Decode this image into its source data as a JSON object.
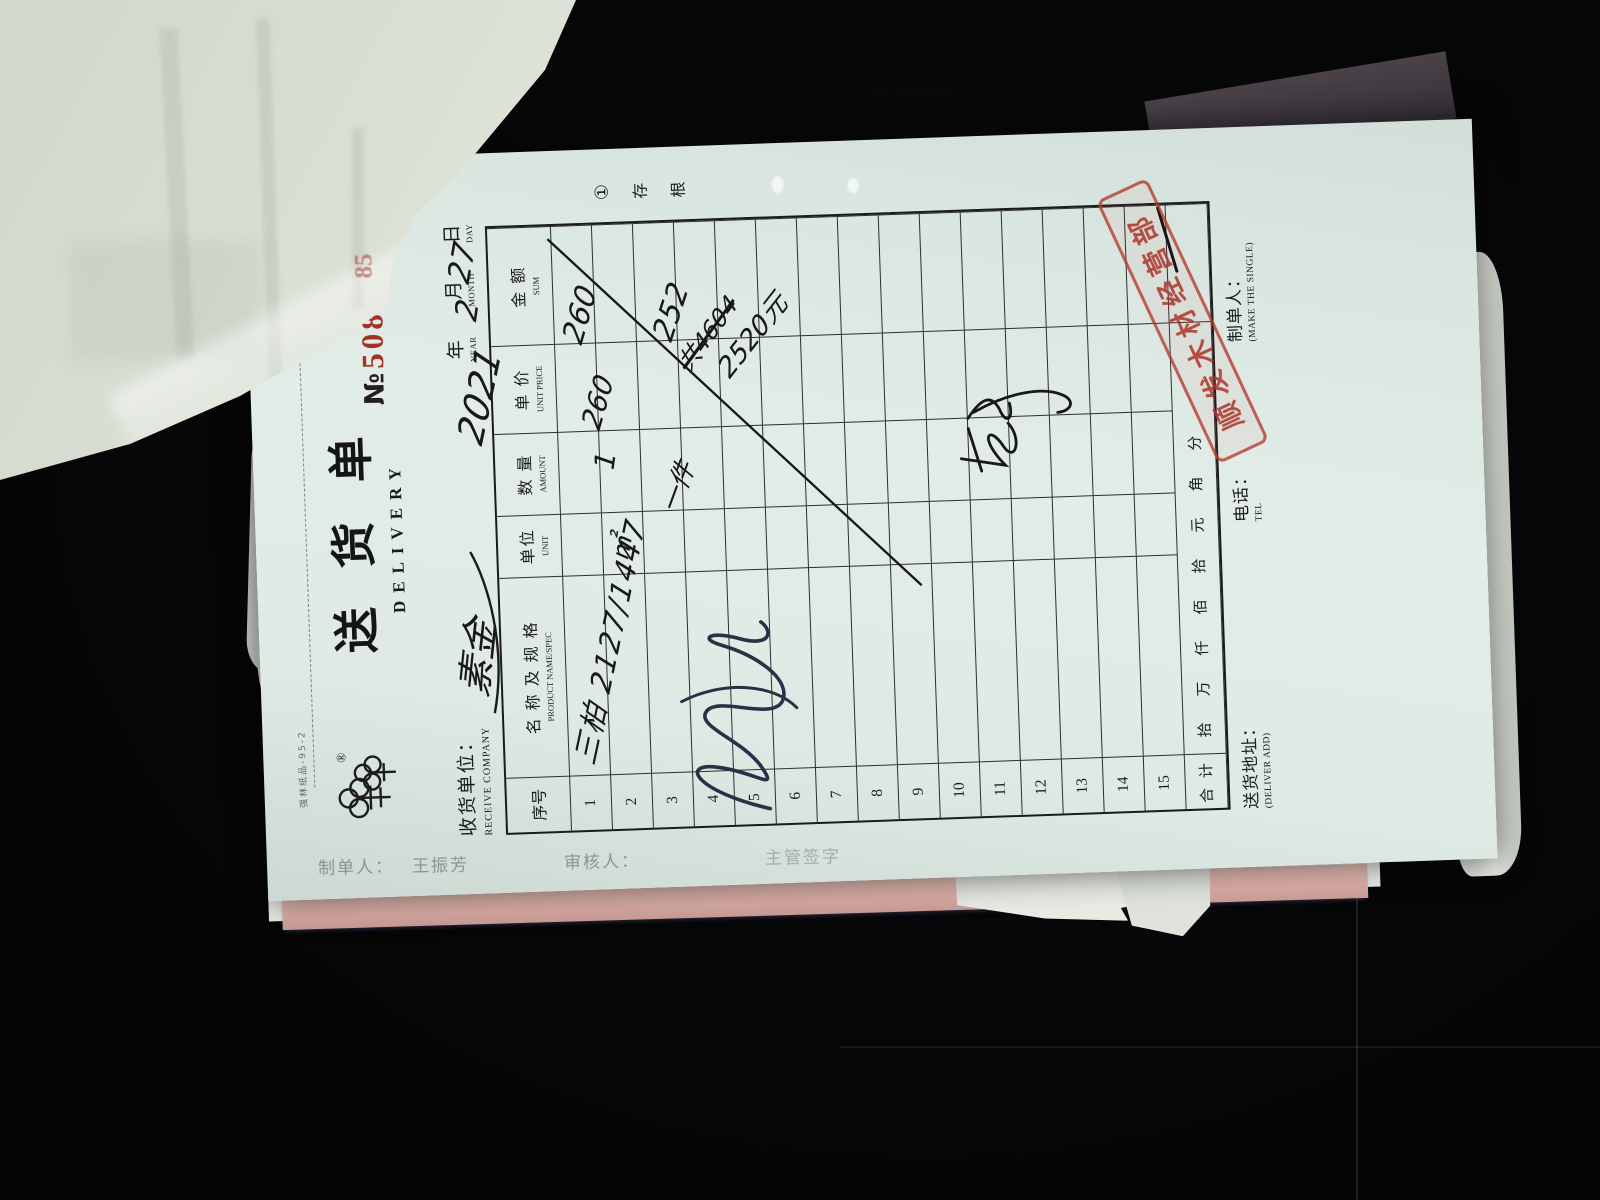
{
  "colors": {
    "background": "#060608",
    "paper": "#dfeae4",
    "pink_sheet": "#e0b4ab",
    "number_red": "#a33226",
    "stamp_red": "#b5463a",
    "ink_black": "#17171c",
    "ink_blue": "#2a3147"
  },
  "form": {
    "edge_print": "强林纸品-95-2",
    "logo": {
      "icon": "double-tree-logo",
      "registered_mark": "®"
    },
    "title_cn": "送 货 单",
    "title_en": "DELIVERY",
    "no_symbol": "№",
    "no_digits": "50850",
    "receive_company_cn": "收货单位：",
    "receive_company_en": "RECEIVE COMPANY",
    "date_line": {
      "year_cn": "年",
      "year_en": "YEAR",
      "month_cn": "月",
      "month_en": "MONTH",
      "day_cn": "日",
      "day_en": "DAY"
    },
    "stub_mark": {
      "circled_one": "①",
      "char1": "存",
      "char2": "根"
    },
    "table": {
      "col_seq_cn": "序号",
      "col_name_cn": "名 称 及 规 格",
      "col_name_en": "PRODUCT NAME/SPEC",
      "col_unit_cn": "单位",
      "col_unit_en": "UNIT",
      "col_qty_cn": "数 量",
      "col_qty_en": "AMOUNT",
      "col_price_cn": "单 价",
      "col_price_en": "UNIT PRICE",
      "col_sum_cn": "金 额",
      "col_sum_en": "SUM",
      "row_numbers": [
        "1",
        "2",
        "3",
        "4",
        "5",
        "6",
        "7",
        "8",
        "9",
        "10",
        "11",
        "12",
        "13",
        "14",
        "15"
      ],
      "total_label": "合 计",
      "money_units": "拾万仟佰拾元角分"
    },
    "footer": {
      "address_cn": "送货地址：",
      "address_en": "(DELIVER ADD)",
      "tel_cn": "电话：",
      "tel_en": "TEL",
      "maker_cn": "制单人：",
      "maker_en": "(MAKE THE SINGLE)"
    },
    "handwriting": {
      "receive_company": "素金",
      "year": "2021",
      "month": "2",
      "day": "27",
      "row1_name": "三柏 2127/1447",
      "row1_unit": "㎡",
      "row1_qty": "1",
      "row1_price": "260",
      "row1_sum": "260",
      "row2_qty": "一件",
      "row2_sum": "252",
      "note_crossed": "共4604",
      "note_total": "2520元"
    },
    "stamp_text": "顺发木材经营部"
  },
  "under_sheet": {
    "maker_label": "制单人：",
    "maker_name": "王振芳",
    "checker_label": "审核人：",
    "right_fragment": "主管签字"
  },
  "flipped_page": {
    "red_fragment": "85"
  }
}
